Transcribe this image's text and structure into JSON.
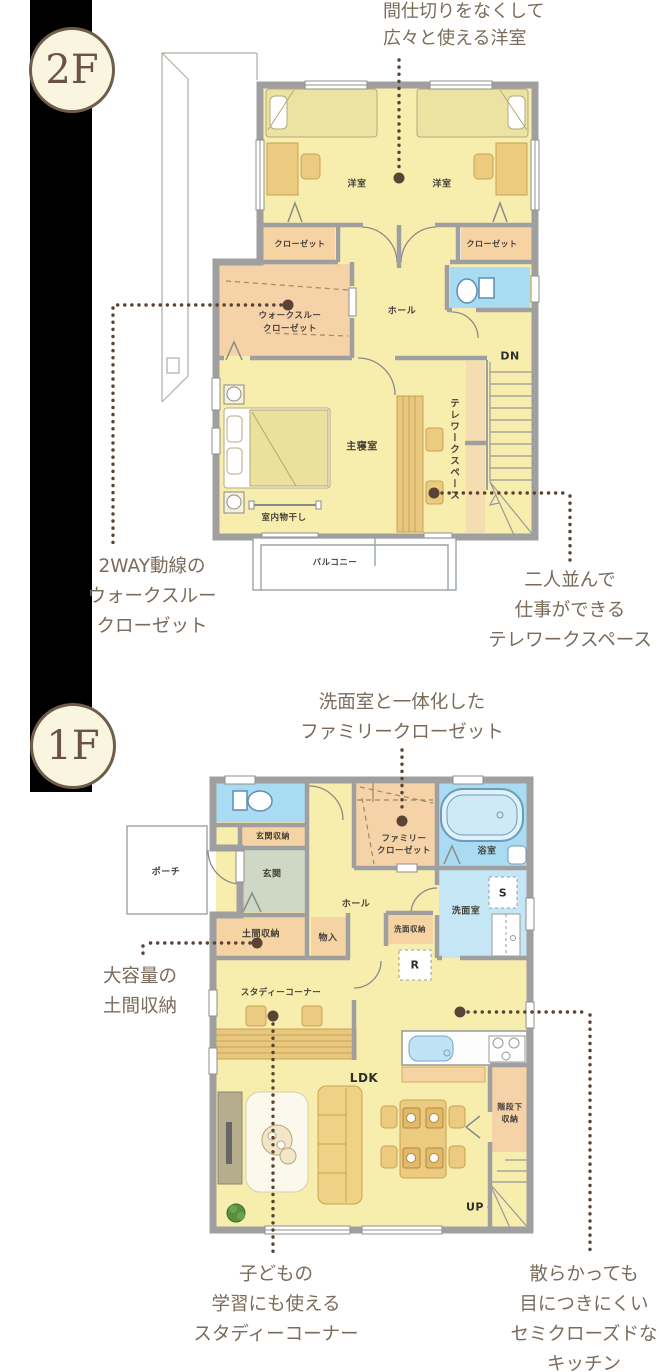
{
  "badges": {
    "f2": "2F",
    "f1": "1F"
  },
  "notes": {
    "partition": [
      "間仕切りをなくして",
      "広々と使える洋室"
    ],
    "wtc": [
      "2WAY動線の",
      "ウォークスルー",
      "クローゼット"
    ],
    "telework": [
      "二人並んで",
      "仕事ができる",
      "テレワークスペース"
    ],
    "family_closet": [
      "洗面室と一体化した",
      "ファミリークローゼット"
    ],
    "doma": [
      "大容量の",
      "土間収納"
    ],
    "study": [
      "子どもの",
      "学習にも使える",
      "スタディーコーナー"
    ],
    "kitchen": [
      "散らかっても",
      "目につきにくい",
      "セミクローズドな",
      "キッチン"
    ]
  },
  "floor2": {
    "rooms": {
      "bedroom_l": "洋室",
      "bedroom_r": "洋室",
      "closet_l": "クローゼット",
      "closet_r": "クローゼット",
      "wtc1": "ウォークスルー",
      "wtc2": "クローゼット",
      "hall": "ホール",
      "master": "主寝室",
      "telework": "テレワークスペース",
      "laundry": "室内物干し",
      "balcony": "バルコニー",
      "dn": "DN"
    }
  },
  "floor1": {
    "rooms": {
      "entry_storage": "玄関収納",
      "entry": "玄関",
      "porch": "ポーチ",
      "fc1": "ファミリー",
      "fc2": "クローゼット",
      "bath": "浴室",
      "hall": "ホール",
      "wash": "洗面室",
      "s": "S",
      "doma": "土間収納",
      "mono": "物入",
      "wash_storage": "洗面収納",
      "r": "R",
      "study": "スタディーコーナー",
      "ldk": "LDK",
      "under1": "階段下",
      "under2": "収納",
      "up": "UP"
    }
  },
  "colors": {
    "wall": "#9f9f9f",
    "room_yellow": "#f7eeae",
    "closet_peach": "#f6d3a2",
    "water_blue": "#a9dcf2",
    "wash_blue": "#c5e6f4",
    "entry_sage": "#ced8c5",
    "wood": "#eccb81",
    "annotation_dot": "#5a4335",
    "note_text": "#7b6b5b",
    "badge_fill": "#faf5df",
    "badge_border": "#6f5d4b"
  }
}
